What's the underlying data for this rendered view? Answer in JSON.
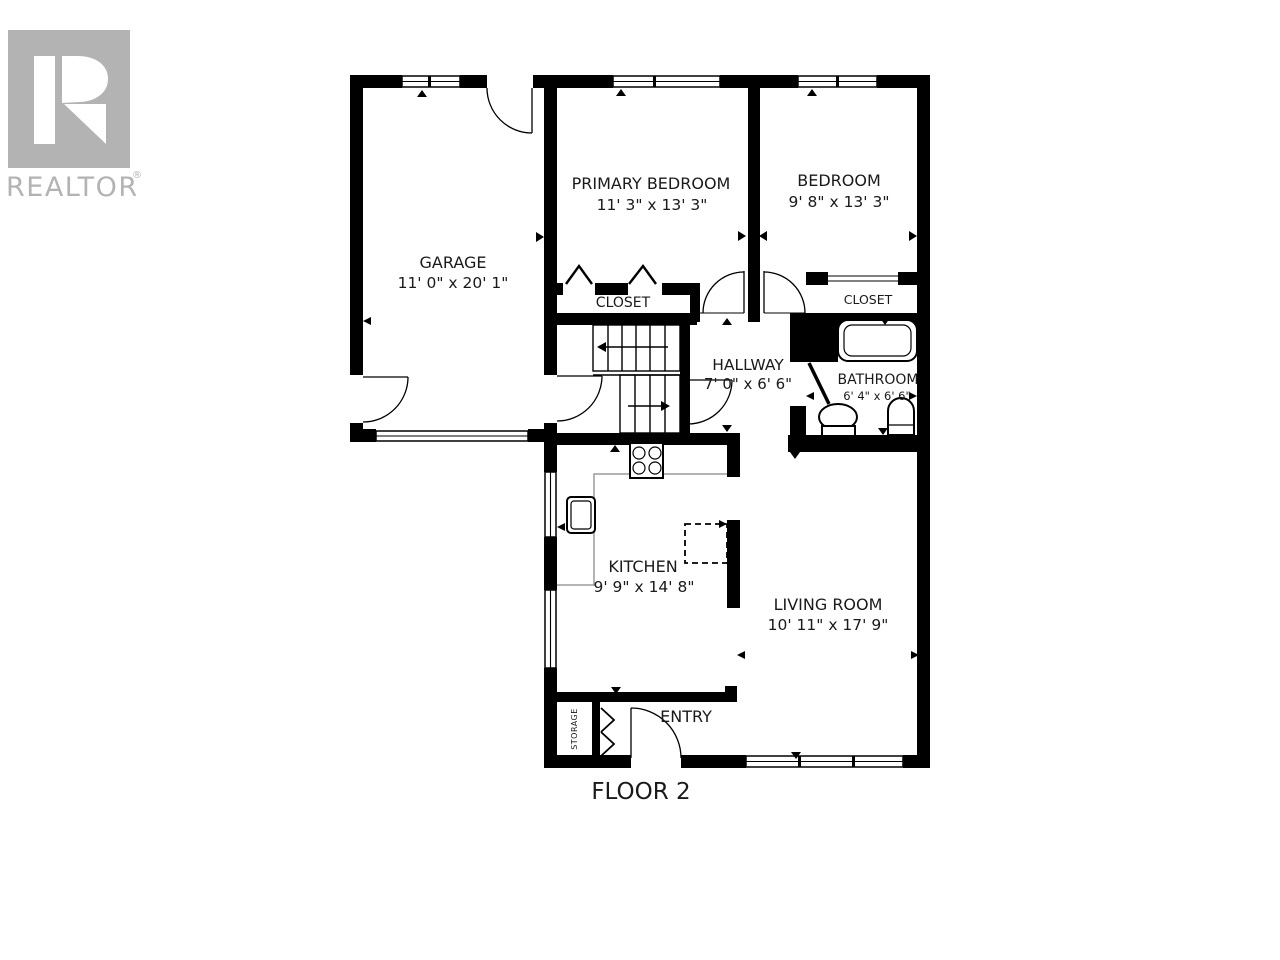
{
  "branding": {
    "logo_text": "REALTOR",
    "registered_mark": "®",
    "logo_color": "#b3b3b3"
  },
  "plan": {
    "floor_label": "FLOOR 2",
    "rooms": {
      "garage": {
        "name": "GARAGE",
        "dims": "11' 0\" x 20' 1\""
      },
      "primary_bedroom": {
        "name": "PRIMARY BEDROOM",
        "dims": "11' 3\" x 13' 3\""
      },
      "bedroom": {
        "name": "BEDROOM",
        "dims": "9' 8\" x 13' 3\""
      },
      "closet_primary": {
        "name": "CLOSET"
      },
      "closet_bedroom": {
        "name": "CLOSET"
      },
      "hallway": {
        "name": "HALLWAY",
        "dims": "7' 0\" x 6' 6\""
      },
      "bathroom": {
        "name": "BATHROOM",
        "dims": "6' 4\" x 6' 6\""
      },
      "kitchen": {
        "name": "KITCHEN",
        "dims": "9' 9\" x 14' 8\""
      },
      "living_room": {
        "name": "LIVING ROOM",
        "dims": "10' 11\" x 17' 9\""
      },
      "entry": {
        "name": "ENTRY"
      },
      "storage": {
        "name": "STORAGE"
      }
    },
    "colors": {
      "wall": "#000000",
      "counter_line": "#9b9b9b",
      "text": "#1a1a1a"
    }
  }
}
